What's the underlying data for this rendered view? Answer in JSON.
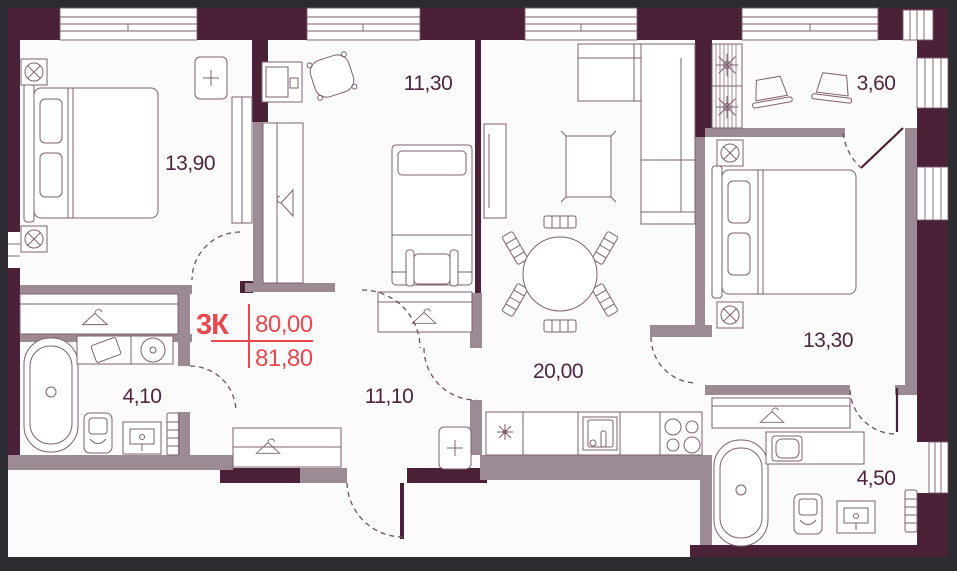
{
  "plan": {
    "type_label": "3К",
    "area_value_top": "80,00",
    "area_value_bottom": "81,80"
  },
  "rooms": [
    {
      "id": "bedroom-1",
      "area_label": "13,90"
    },
    {
      "id": "bedroom-2",
      "area_label": "11,30"
    },
    {
      "id": "loggia",
      "area_label": "3,60"
    },
    {
      "id": "bedroom-3",
      "area_label": "13,30"
    },
    {
      "id": "kitchen-living-room",
      "area_label": "20,00"
    },
    {
      "id": "hallway",
      "area_label": "11,10"
    },
    {
      "id": "bathroom-1",
      "area_label": "4,10"
    },
    {
      "id": "bathroom-2",
      "area_label": "4,50"
    }
  ],
  "colors": {
    "background": "#2b2b30",
    "floor": "#fcfbfc",
    "wall_exterior": "#4a2136",
    "wall_partition": "#9c8b94",
    "furniture_line": "#7e5f70",
    "room_label": "#4f2440",
    "accent_red": "#e8484e"
  },
  "icons": [
    "hanger-icon",
    "socket-icon",
    "electric-panel-icon",
    "hob-burner-icon",
    "plant-icon",
    "sink-icon",
    "stove-icon",
    "toilet-icon",
    "bathtub-icon",
    "washing-machine-icon",
    "towel-radiator-icon",
    "door-swing-arc"
  ]
}
